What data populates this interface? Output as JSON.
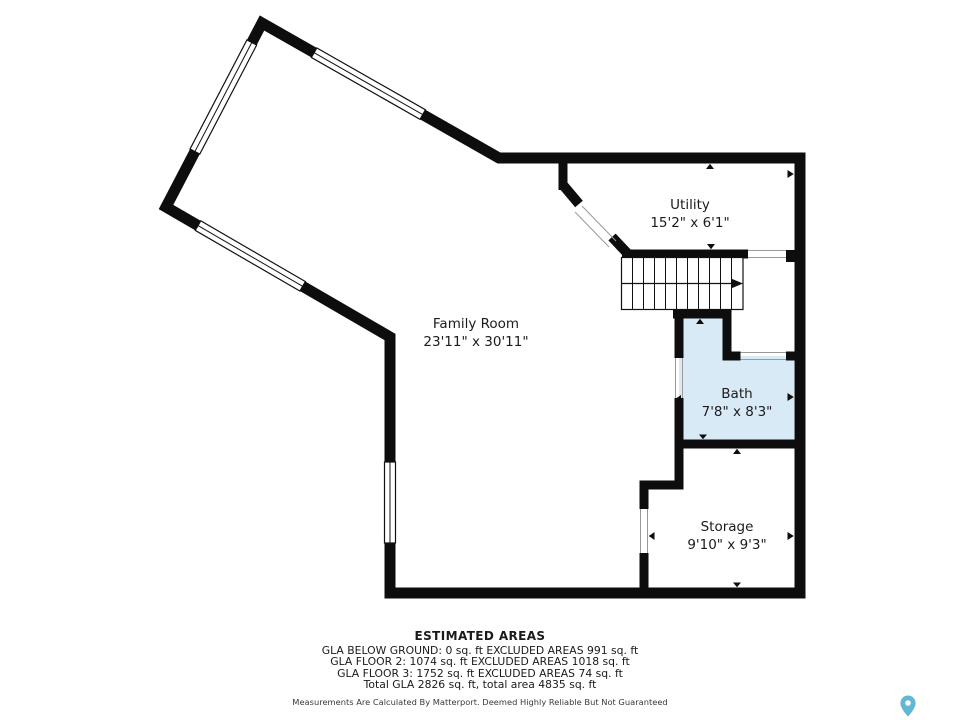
{
  "floor_plan": {
    "rooms": {
      "family_room": {
        "name": "Family Room",
        "dimensions": "23'11\" x 30'11\""
      },
      "utility": {
        "name": "Utility",
        "dimensions": "15'2\" x 6'1\""
      },
      "bath": {
        "name": "Bath",
        "dimensions": "7'8\" x 8'3\""
      },
      "storage": {
        "name": "Storage",
        "dimensions": "9'10\" x 9'3\""
      }
    }
  },
  "colors": {
    "wall": "#0d0d0d",
    "bath_fill": "#d9eaf7",
    "pin": "#63b7d5",
    "background": "#ffffff"
  },
  "footer": {
    "title": "ESTIMATED AREAS",
    "lines": [
      "GLA BELOW GROUND: 0 sq. ft EXCLUDED AREAS 991 sq. ft",
      "GLA FLOOR 2: 1074 sq. ft EXCLUDED AREAS 1018 sq. ft",
      "GLA FLOOR 3: 1752 sq. ft EXCLUDED AREAS 74 sq. ft",
      "Total GLA 2826 sq. ft, total area 4835 sq. ft"
    ],
    "disclaimer": "Measurements Are Calculated By Matterport. Deemed Highly Reliable But Not Guaranteed"
  }
}
